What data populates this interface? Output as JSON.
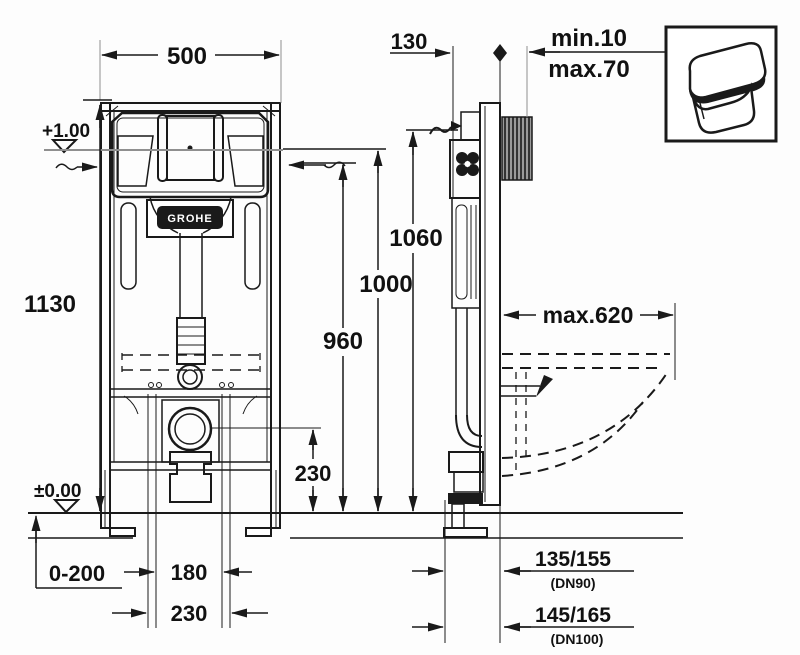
{
  "drawing": {
    "brand_label": "GROHE",
    "colors": {
      "line": "#1a1a1a",
      "gray": "#8f8f8f",
      "paper": "#fdfdfd"
    },
    "dimensions": {
      "frame_width": "500",
      "frame_depth": "130",
      "wall_min": "min.10",
      "wall_max": "max.70",
      "frame_height": "1130",
      "supply_height": "1060",
      "top_height": "1000",
      "cistern_top_height": "960",
      "bowl_projection": "max.620",
      "drain_center_height": "230",
      "level_plus": "+1.00",
      "level_zero": "±0.00",
      "leg_adjust": "0-200",
      "outlet_width": "180",
      "outlet_outer_width": "230",
      "drain_dn90_offset": "135/155",
      "drain_dn90_label": "(DN90)",
      "drain_dn100_offset": "145/165",
      "drain_dn100_label": "(DN100)"
    }
  }
}
